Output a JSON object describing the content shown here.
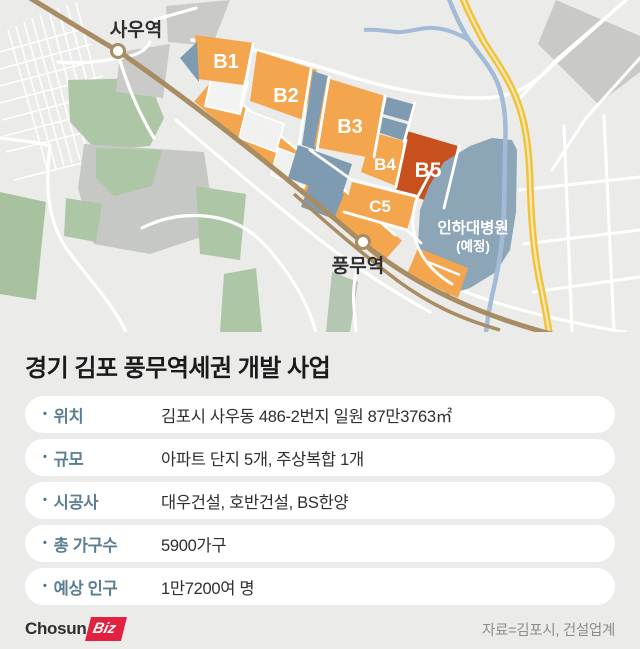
{
  "map": {
    "stations": [
      {
        "name": "사우역"
      },
      {
        "name": "풍무역"
      }
    ],
    "blocks": [
      {
        "label": "B1",
        "color": "#F4A64E"
      },
      {
        "label": "B2",
        "color": "#F4A64E"
      },
      {
        "label": "B3",
        "color": "#F4A64E"
      },
      {
        "label": "B4",
        "color": "#F4A64E"
      },
      {
        "label": "B5",
        "color": "#C8501D"
      },
      {
        "label": "C5",
        "color": "#F4A64E"
      }
    ],
    "hospital": {
      "line1": "인하대병원",
      "line2": "(예정)"
    },
    "colors": {
      "background": "#EBEBE9",
      "block_orange": "#F4A64E",
      "block_red": "#C8501D",
      "block_bluegray": "#7E9BB2",
      "hospital_blue": "#8CA6B8",
      "railway_brown": "#A88C64",
      "road_yellow": "#F1C237",
      "river_blue": "#A4BBD8",
      "park_green": "#ADC6A5",
      "gray_block": "#CACBC8"
    }
  },
  "info": {
    "title": "경기 김포 풍무역세권 개발 사업",
    "bullet": "•",
    "rows": [
      {
        "label": "위치",
        "value": "김포시 사우동 486-2번지 일원 87만3763㎡"
      },
      {
        "label": "규모",
        "value": "아파트 단지 5개, 주상복합 1개"
      },
      {
        "label": "시공사",
        "value": "대우건설, 호반건설, BS한양"
      },
      {
        "label": "총 가구수",
        "value": "5900가구"
      },
      {
        "label": "예상 인구",
        "value": "1만7200여 명"
      }
    ]
  },
  "footer": {
    "logo": {
      "chosun": "Chosun",
      "biz": "Biz"
    },
    "source": "자료=김포시, 건설업계",
    "logo_red": "#E2203F"
  }
}
